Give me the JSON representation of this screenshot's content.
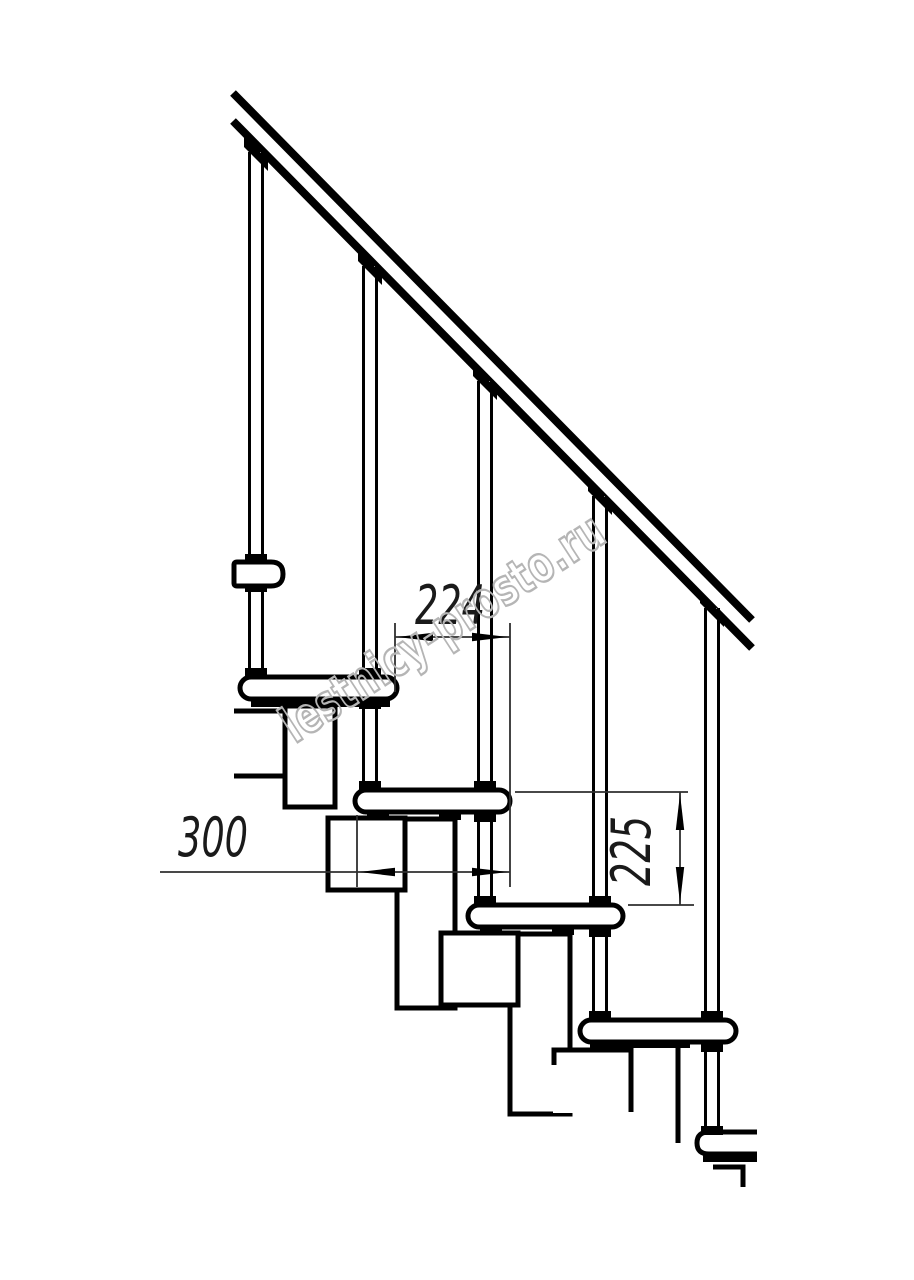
{
  "drawing": {
    "watermark": {
      "text": "lestnicy-prosto.ru",
      "color": "#b5b5b5"
    },
    "colors": {
      "line": "#000000",
      "dimension_line": "#2f2f2f",
      "text": "#1a1a1a",
      "background": "#ffffff"
    },
    "dimensions": {
      "step_going": {
        "value": "224",
        "orientation": "horizontal"
      },
      "tread_depth": {
        "value": "300",
        "orientation": "horizontal"
      },
      "step_rise": {
        "value": "225",
        "orientation": "vertical"
      }
    },
    "elements": {
      "treads_visible": 6,
      "balusters_visible": 5,
      "handrail": "diagonal double line"
    }
  }
}
